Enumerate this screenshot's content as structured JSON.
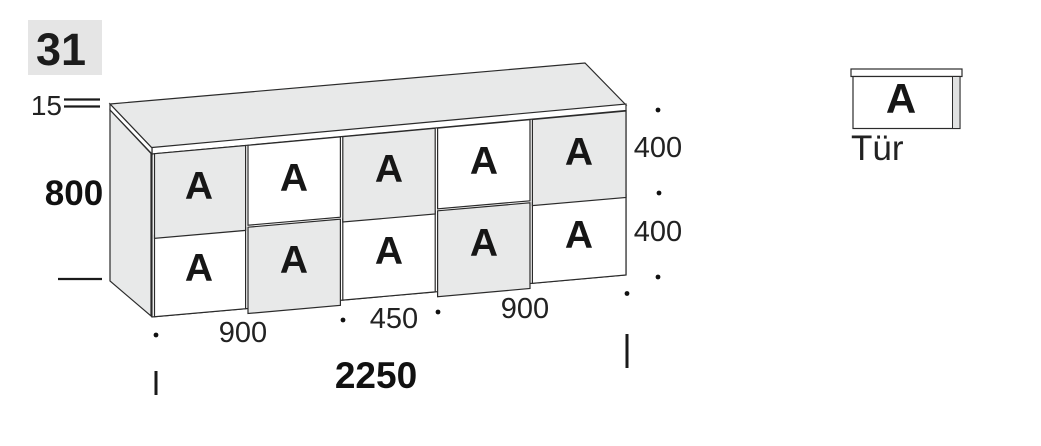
{
  "page": {
    "badge": "31"
  },
  "cabinet": {
    "dimensions": {
      "top_thickness": "15",
      "height": "800",
      "row_heights": [
        "400",
        "400"
      ],
      "bottom_widths": [
        "900",
        "450",
        "900"
      ],
      "total_width": "2250"
    },
    "doors": [
      {
        "row": 1,
        "col": 1,
        "label": "A",
        "shaded": true
      },
      {
        "row": 1,
        "col": 2,
        "label": "A",
        "shaded": false
      },
      {
        "row": 1,
        "col": 3,
        "label": "A",
        "shaded": true
      },
      {
        "row": 1,
        "col": 4,
        "label": "A",
        "shaded": false
      },
      {
        "row": 1,
        "col": 5,
        "label": "A",
        "shaded": true
      },
      {
        "row": 2,
        "col": 1,
        "label": "A",
        "shaded": false
      },
      {
        "row": 2,
        "col": 2,
        "label": "A",
        "shaded": true
      },
      {
        "row": 2,
        "col": 3,
        "label": "A",
        "shaded": false
      },
      {
        "row": 2,
        "col": 4,
        "label": "A",
        "shaded": true
      },
      {
        "row": 2,
        "col": 5,
        "label": "A",
        "shaded": false
      }
    ]
  },
  "legend": {
    "symbol": "A",
    "label": "Tür"
  },
  "colors": {
    "panel_fill": "#e8e9e9",
    "door_light": "#ffffff",
    "line": "#2b2b2b",
    "text": "#222222",
    "badge_bg": "#e5e5e5"
  }
}
